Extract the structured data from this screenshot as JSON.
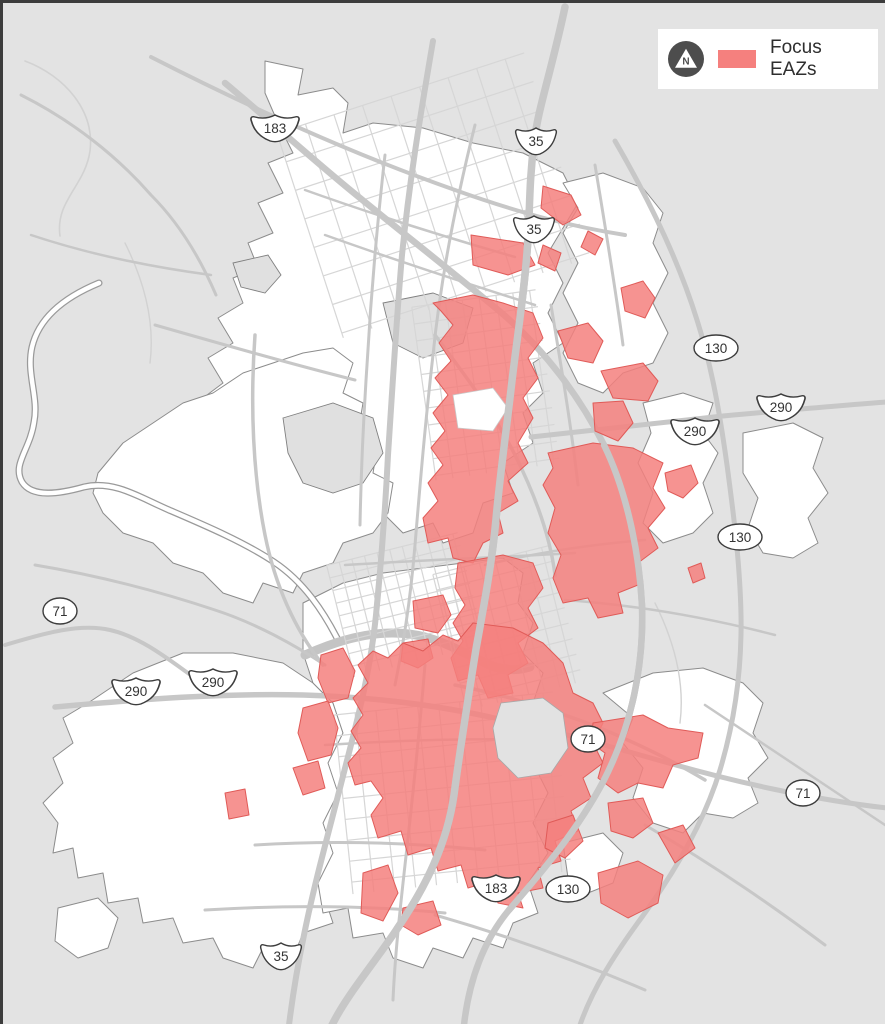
{
  "page": {
    "background_color": "#e3e3e3",
    "border_color": "#3c3c3c"
  },
  "legend": {
    "label": "Focus EAZs",
    "swatch_color": "#F5807E",
    "north_arrow_letter": "N"
  },
  "map": {
    "colors": {
      "background": "#e3e3e3",
      "city_fill": "#ffffff",
      "city_outline": "#8c8c8c",
      "road": "#c7c7c7",
      "minor_road": "#d6d6d6",
      "eaz_fill": "#F5807E",
      "eaz_stroke": "#E05B58",
      "water_outline": "#9a9a9a"
    },
    "shields": [
      {
        "shape": "us",
        "label": "183",
        "x": 272,
        "y": 125
      },
      {
        "shape": "us",
        "label": "35",
        "x": 533,
        "y": 138
      },
      {
        "shape": "us",
        "label": "35",
        "x": 531,
        "y": 226
      },
      {
        "shape": "oval",
        "label": "130",
        "x": 713,
        "y": 345
      },
      {
        "shape": "us",
        "label": "290",
        "x": 778,
        "y": 404
      },
      {
        "shape": "us",
        "label": "290",
        "x": 692,
        "y": 428
      },
      {
        "shape": "oval",
        "label": "130",
        "x": 737,
        "y": 534
      },
      {
        "shape": "oval",
        "label": "71",
        "x": 57,
        "y": 608
      },
      {
        "shape": "us",
        "label": "290",
        "x": 133,
        "y": 688
      },
      {
        "shape": "us",
        "label": "290",
        "x": 210,
        "y": 679
      },
      {
        "shape": "oval",
        "label": "71",
        "x": 585,
        "y": 736
      },
      {
        "shape": "oval",
        "label": "71",
        "x": 800,
        "y": 790
      },
      {
        "shape": "us",
        "label": "183",
        "x": 493,
        "y": 885
      },
      {
        "shape": "oval",
        "label": "130",
        "x": 565,
        "y": 886
      },
      {
        "shape": "us",
        "label": "35",
        "x": 278,
        "y": 953
      }
    ]
  }
}
